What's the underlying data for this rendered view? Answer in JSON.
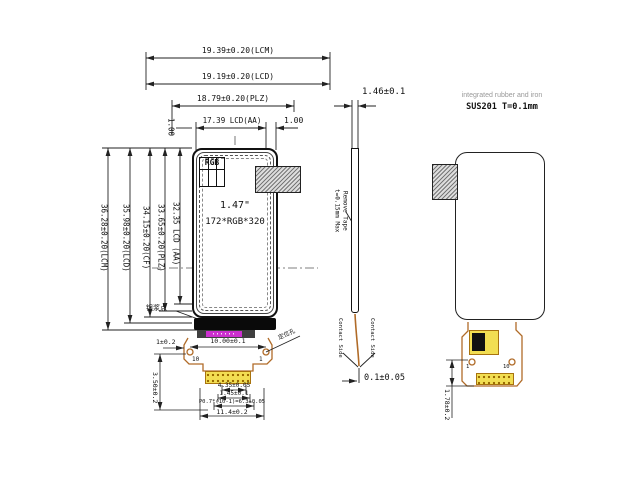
{
  "front": {
    "dim_top": [
      "19.39±0.20(LCM)",
      "19.19±0.20(LCD)",
      "18.79±0.20(PLZ)",
      "17.39  LCD(AA)"
    ],
    "dim_margin_left": "1.00",
    "dim_margin_right": "1.00",
    "dim_left": [
      "36.28±0.20(LCM)",
      "35.98±0.20(LCD)",
      "34.15±0.20(CF)",
      "33.65±0.20(PLZ)",
      "32.35 LCD (AA)"
    ],
    "panel": {
      "corner_label": "RGB",
      "size": "1.47\"",
      "resolution": "172*RGB*320"
    },
    "silver_dot_note": "银浆点",
    "connector": {
      "dim_edge": "1±0.2",
      "dim_holes": "10.00±0.1",
      "hole_note": "定位孔",
      "dim_height": "3.50±0.2",
      "dim_finger": "4.35±0.05",
      "dim_pin": "1.45±0.1",
      "dim_pitch": "P0.7*(10-1)=6.3±0.05",
      "dim_width": "11.4±0.2",
      "pin_left": "10",
      "pin_right": "1"
    }
  },
  "side": {
    "dim_thickness": "1.46±0.1",
    "tape_note_1": "Remove Tape",
    "tape_note_2": "t=0.15mm Max",
    "tail_note_left": "Contact Side",
    "tail_note_right": "Contact Side",
    "dim_protrusion": "0.1±0.05"
  },
  "back": {
    "material_note": "integrated rubber and iron",
    "material_spec": "SUS201  T=0.1mm",
    "dim_tail": "1.78±0.2",
    "pin_left": "1",
    "pin_right": "10"
  }
}
